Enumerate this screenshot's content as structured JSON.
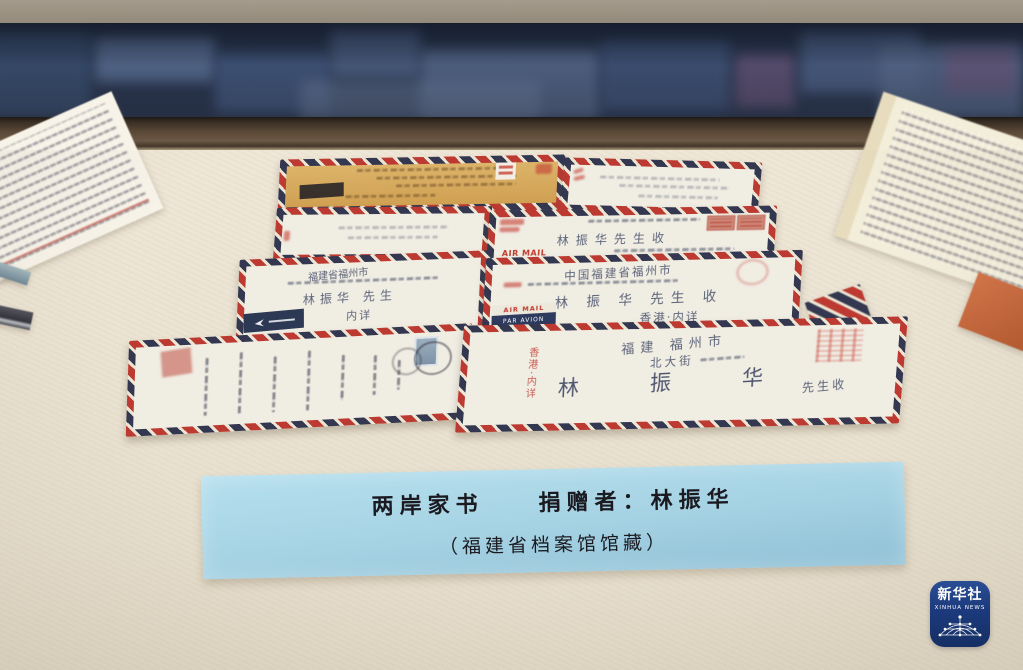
{
  "label_card": {
    "title": "两岸家书",
    "donor_label": "捐赠者：林振华",
    "collection_note": "（福建省档案馆馆藏）",
    "bg_color": "#a8d4e4",
    "text_color": "#1a1a20"
  },
  "watermark": {
    "cn": "新华社",
    "en": "XINHUA NEWS",
    "bg_color": "#1c3a7c"
  },
  "envelopes": {
    "stripe_red": "#bc3a31",
    "stripe_blue": "#333750",
    "e1": {
      "body_color": "#d7aa5d"
    },
    "e4": {
      "addressee": "林振华先生收",
      "airmail_text": "AIR MAIL"
    },
    "e5": {
      "line1": "福建省福州市",
      "line3": "林振华 先生",
      "line4": "内详"
    },
    "e6": {
      "line1": "中国福建省福州市",
      "line3": "林 振 华 先生 收",
      "line4": "香港·内详",
      "sticker_line1": "AIR MAIL",
      "sticker_line2": "PAR AVION"
    },
    "e8": {
      "line1": "福建 福州市",
      "line2": "北大街",
      "addressee_name": "林 振 华",
      "addressee_suffix": "先生收",
      "side_note": "香港·内详"
    }
  }
}
